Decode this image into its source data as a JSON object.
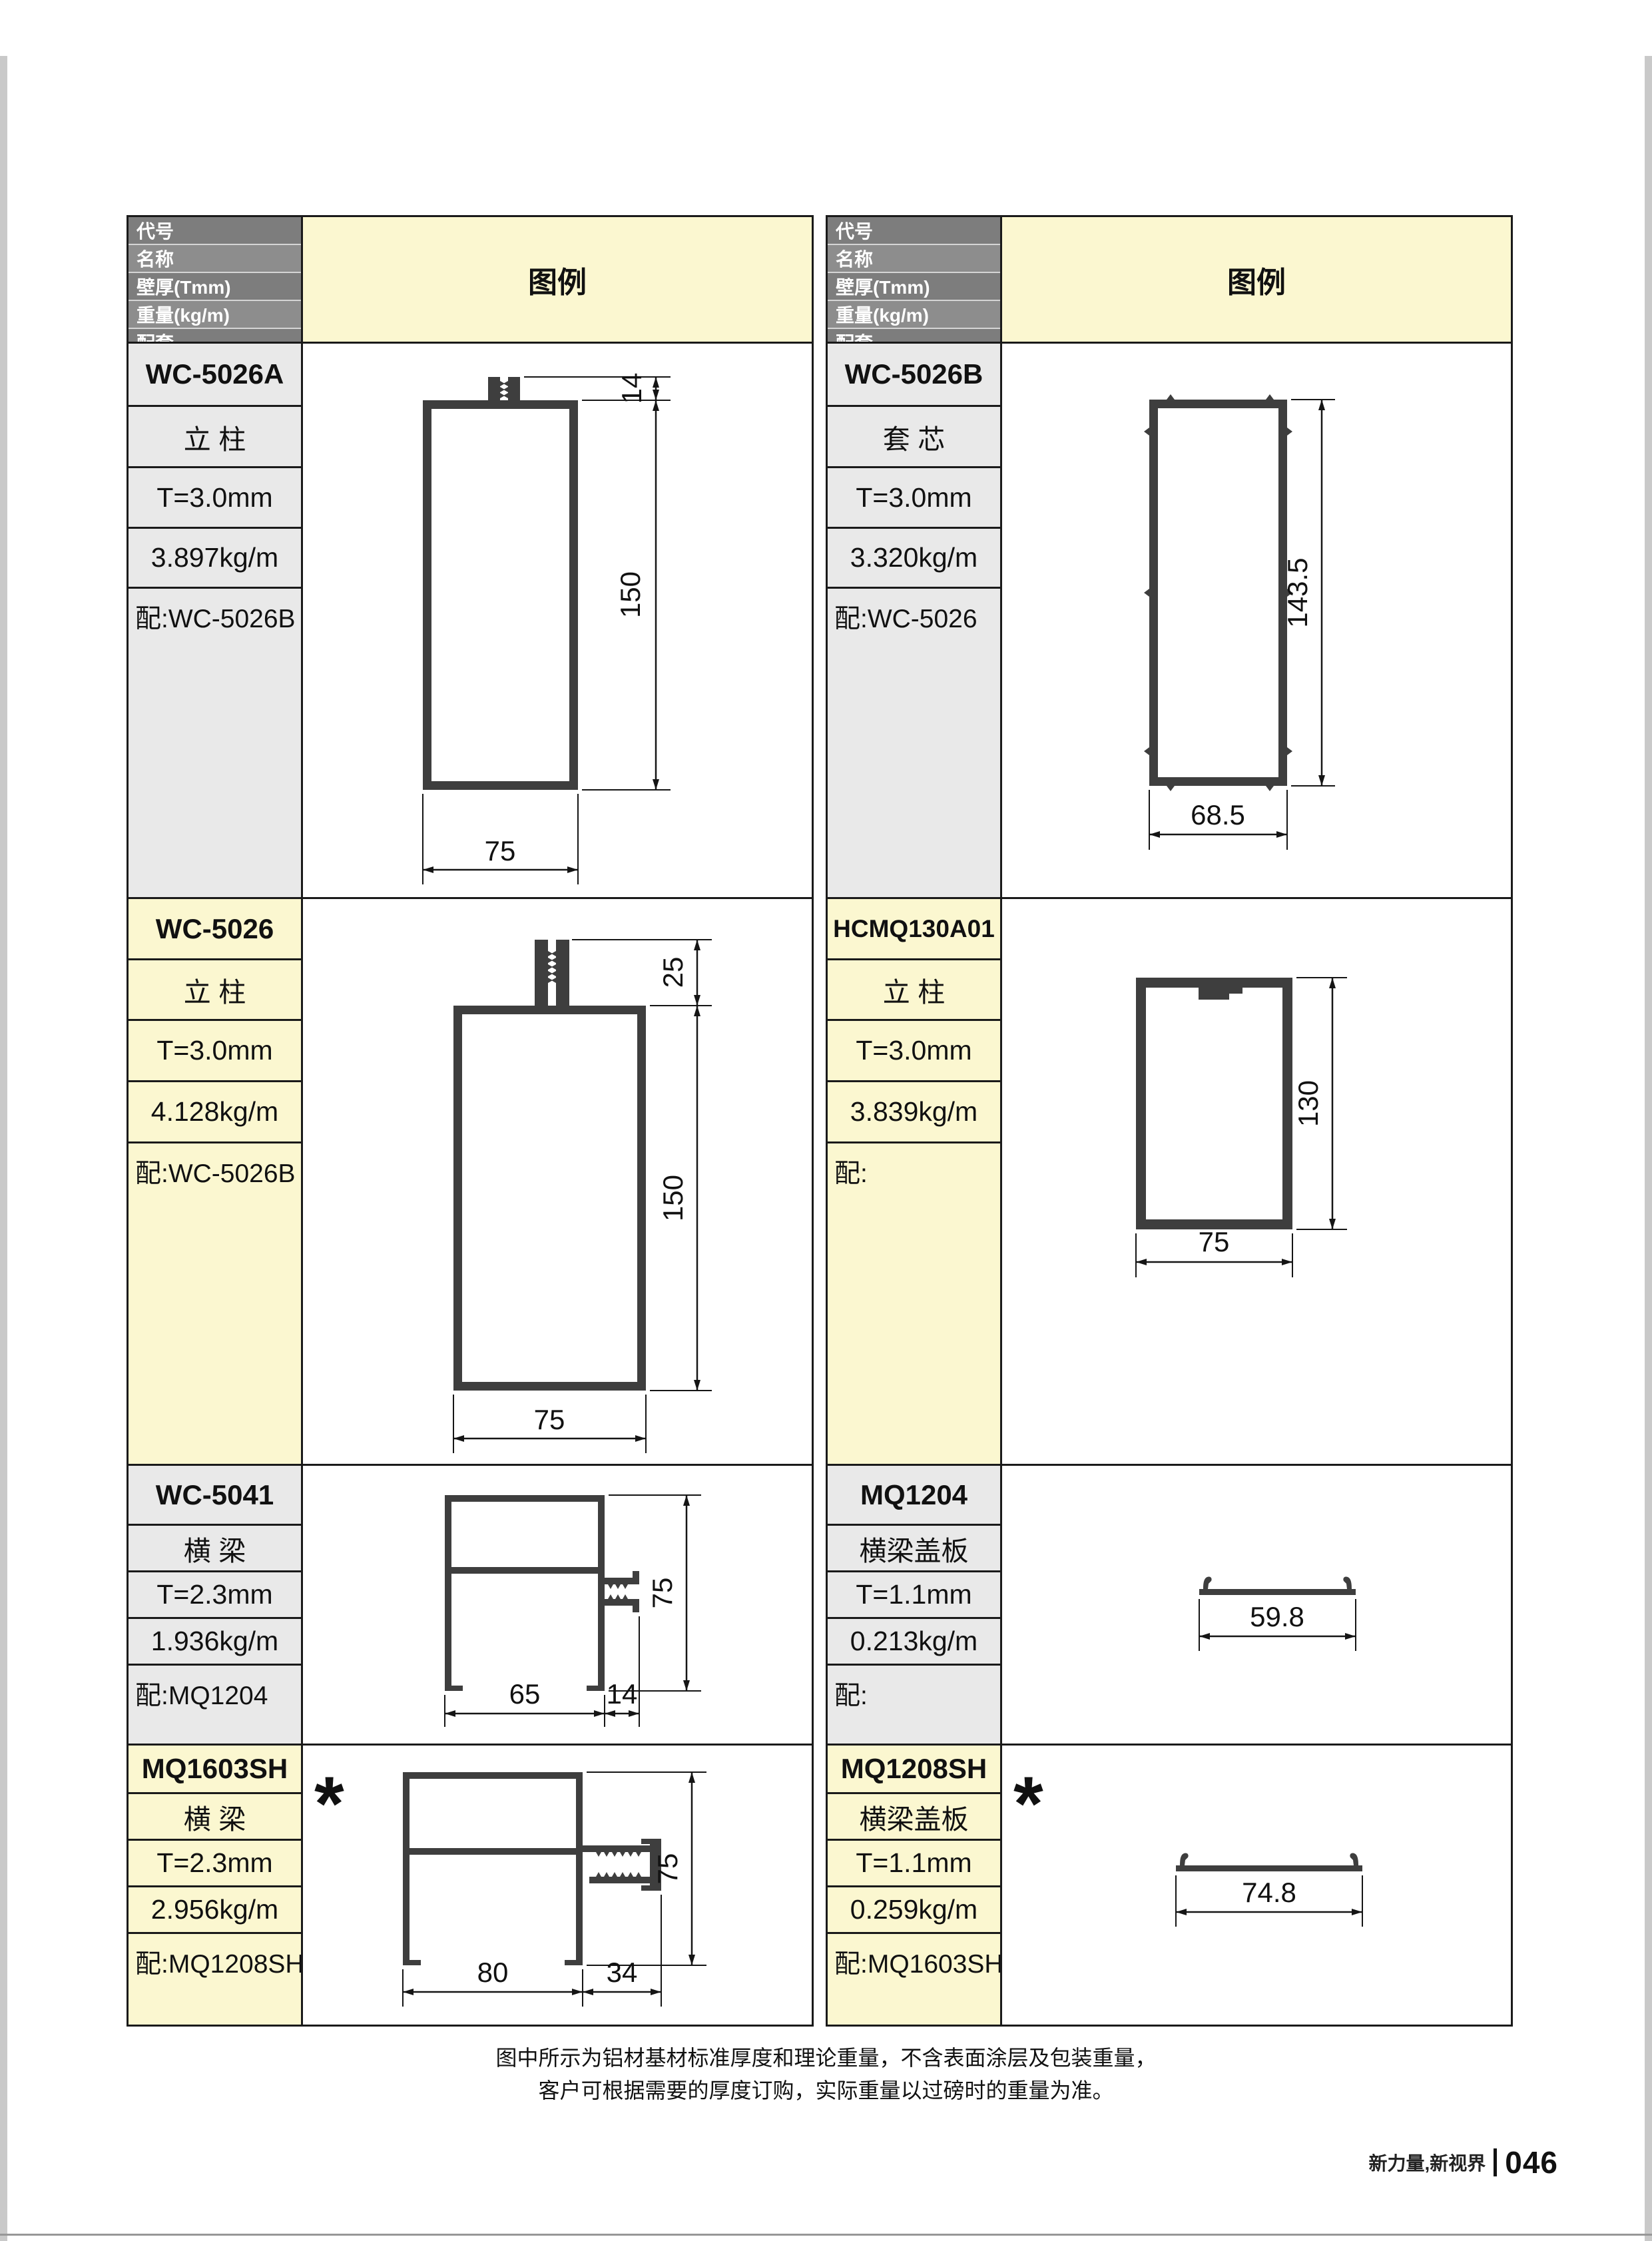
{
  "header": {
    "code": "代号",
    "name": "名称",
    "thickness": "壁厚(Tmm)",
    "weight": "重量(kg/m)",
    "match": "配套",
    "legend": "图例"
  },
  "profiles": [
    {
      "code": "WC-5026A",
      "name": "立 柱",
      "thickness": "T=3.0mm",
      "weight": "3.897kg/m",
      "match": "配:WC-5026B",
      "dims": {
        "tab": "14",
        "h": "150",
        "w": "75"
      }
    },
    {
      "code": "WC-5026",
      "name": "立 柱",
      "thickness": "T=3.0mm",
      "weight": "4.128kg/m",
      "match": "配:WC-5026B",
      "dims": {
        "tab": "25",
        "h": "150",
        "w": "75"
      }
    },
    {
      "code": "WC-5041",
      "name": "横 梁",
      "thickness": "T=2.3mm",
      "weight": "1.936kg/m",
      "match": "配:MQ1204",
      "dims": {
        "w1": "65",
        "w2": "14",
        "h": "75"
      }
    },
    {
      "code": "MQ1603SH",
      "name": "横 梁",
      "thickness": "T=2.3mm",
      "weight": "2.956kg/m",
      "match": "配:MQ1208SH",
      "dims": {
        "w1": "80",
        "w2": "34",
        "h": "75"
      },
      "star": "*"
    },
    {
      "code": "WC-5026B",
      "name": "套 芯",
      "thickness": "T=3.0mm",
      "weight": "3.320kg/m",
      "match": "配:WC-5026",
      "dims": {
        "h": "143.5",
        "w": "68.5"
      }
    },
    {
      "code": "HCMQ130A01",
      "name": "立 柱",
      "thickness": "T=3.0mm",
      "weight": "3.839kg/m",
      "match": "配:",
      "dims": {
        "h": "130",
        "w": "75"
      }
    },
    {
      "code": "MQ1204",
      "name": "横梁盖板",
      "thickness": "T=1.1mm",
      "weight": "0.213kg/m",
      "match": "配:",
      "dims": {
        "w": "59.8"
      }
    },
    {
      "code": "MQ1208SH",
      "name": "横梁盖板",
      "thickness": "T=1.1mm",
      "weight": "0.259kg/m",
      "match": "配:MQ1603SH",
      "dims": {
        "w": "74.8"
      },
      "star": "*"
    }
  ],
  "notes": [
    "图中所示为铝材基材标准厚度和理论重量，不含表面涂层及包装重量，",
    "客户可根据需要的厚度订购，实际重量以过磅时的重量为准。"
  ],
  "footer": {
    "brand": "新力量,新视界",
    "page": "046"
  },
  "colors": {
    "row_gray": "#e9e9e9",
    "row_yellow": "#fbf7d0",
    "header_gray": "#868686",
    "profile_fill": "#3e3e3e"
  }
}
